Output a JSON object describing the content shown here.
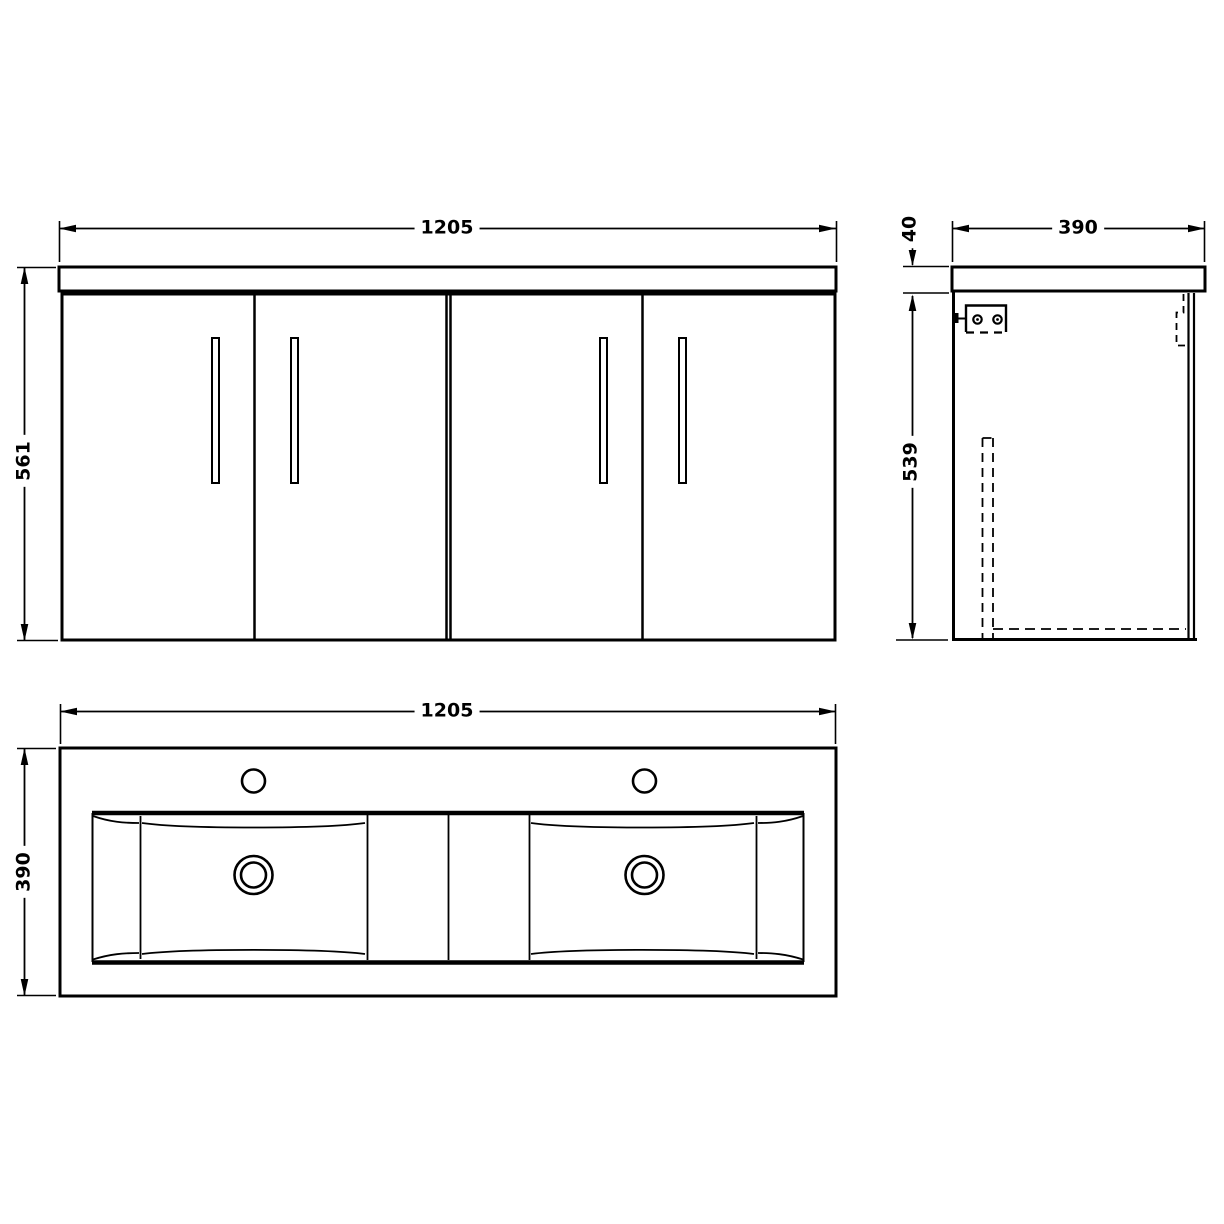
{
  "front_view": {
    "width_mm": "1205",
    "height_mm": "561"
  },
  "side_view": {
    "counter_thickness_mm": "40",
    "depth_mm": "390",
    "body_height_mm": "539"
  },
  "plan_view": {
    "width_mm": "1205",
    "depth_mm": "390"
  },
  "style": {
    "line_color": "#000000",
    "background_color": "#ffffff"
  }
}
